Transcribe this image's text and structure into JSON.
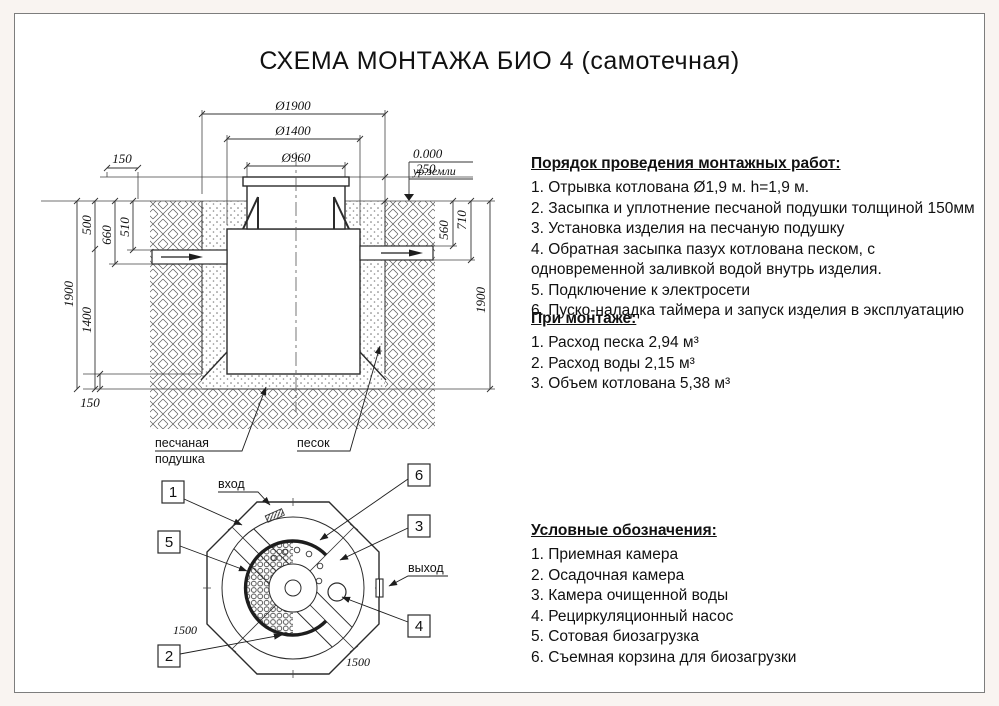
{
  "page": {
    "title": "СХЕМА МОНТАЖА БИО 4 (самотечная)"
  },
  "section_view": {
    "dims": {
      "dia1900": "Ø1900",
      "dia1400": "Ø1400",
      "dia960": "Ø960",
      "top150": "150",
      "gap250": "250",
      "left500": "500",
      "left660": "660",
      "left510": "510",
      "left1900": "1900",
      "left1400": "1400",
      "bottom150": "150",
      "right560": "560",
      "right710": "710",
      "right1900": "1900"
    },
    "level_mark": {
      "value": "0.000",
      "label": "ур.земли"
    },
    "labels": {
      "cushion_line1": "песчаная",
      "cushion_line2": "подушка",
      "sand": "песок"
    }
  },
  "plan_view": {
    "labels": {
      "inlet": "вход",
      "outlet": "выход"
    },
    "dims": {
      "across_a": "1500",
      "across_b": "1500"
    },
    "callouts": {
      "c1": "1",
      "c2": "2",
      "c3": "3",
      "c4": "4",
      "c5": "5",
      "c6": "6"
    }
  },
  "instructions": {
    "title": "Порядок проведения монтажных работ:",
    "items": [
      "1. Отрывка котлована Ø1,9 м. h=1,9 м.",
      "2. Засыпка и уплотнение песчаной подушки толщиной 150мм",
      "3. Установка изделия на песчаную подушку",
      "4. Обратная засыпка пазух котлована песком, с одновременной заливкой водой внутрь изделия.",
      "5. Подключение к электросети",
      "6. Пуско-наладка таймера и запуск изделия в эксплуатацию"
    ]
  },
  "montage": {
    "title": "При монтаже:",
    "items": [
      "1. Расход песка 2,94 м³",
      "2. Расход воды 2,15 м³",
      "3. Объем котлована 5,38 м³"
    ]
  },
  "legend": {
    "title": "Условные обозначения:",
    "items": [
      "1. Приемная камера",
      "2. Осадочная камера",
      "3. Камера очищенной воды",
      "4. Рециркуляционный насос",
      "5. Сотовая биозагрузка",
      "6. Съемная корзина для биозагрузки"
    ]
  }
}
